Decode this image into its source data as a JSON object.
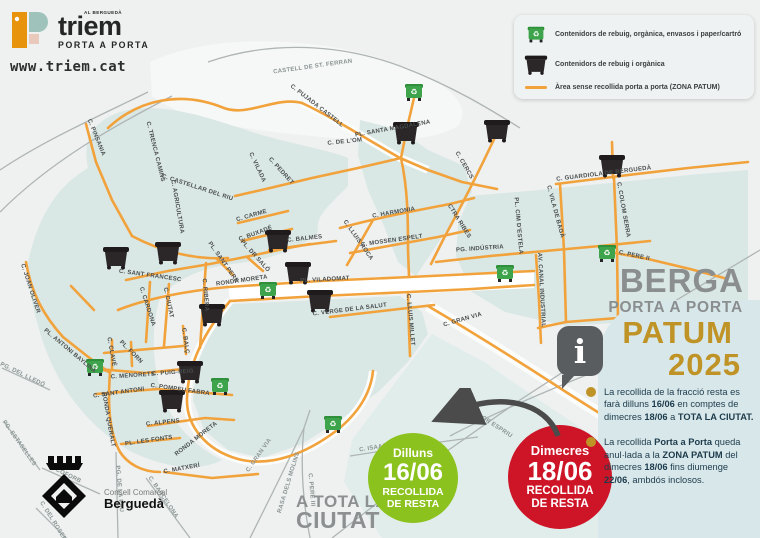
{
  "brand": {
    "tagline": "AL BERGUEDÀ",
    "name": "triem",
    "subtitle": "PORTA A PORTA",
    "website": "www.triem.cat"
  },
  "legend": {
    "items": [
      {
        "icon": "green-container-icon",
        "label": "Contenidors de rebuig, orgànica, envasos i paper/cartró"
      },
      {
        "icon": "black-container-icon",
        "label": "Contenidors de rebuig i orgànica"
      },
      {
        "icon": "orange-line-icon",
        "label": "Àrea sense recollida porta a porta (ZONA PATUM)"
      }
    ]
  },
  "info_panel": {
    "city": "BERGA",
    "subtitle": "PORTA A PORTA",
    "event": "PATUM",
    "year": "2025",
    "info_icon": "i",
    "bullets": [
      {
        "segments": [
          {
            "t": "La recollida de la fracció resta es farà dilluns "
          },
          {
            "t": "16/06",
            "b": true
          },
          {
            "t": " en comptes de dimecres "
          },
          {
            "t": "18/06",
            "b": true
          },
          {
            "t": " a "
          },
          {
            "t": "TOTA LA CIUTAT.",
            "b": true
          }
        ]
      },
      {
        "segments": [
          {
            "t": "La recollida "
          },
          {
            "t": "Porta a Porta",
            "b": true
          },
          {
            "t": " queda anul·lada a la "
          },
          {
            "t": "ZONA PATUM",
            "b": true
          },
          {
            "t": " del dimecres "
          },
          {
            "t": "18/06",
            "b": true
          },
          {
            "t": " fins diumenge "
          },
          {
            "t": "22/06",
            "b": true
          },
          {
            "t": ", ambdós inclosos."
          }
        ]
      }
    ]
  },
  "badges": {
    "green": {
      "day": "Dilluns",
      "date": "16/06",
      "line1": "RECOLLIDA",
      "line2": "DE RESTA"
    },
    "red": {
      "day": "Dimecres",
      "date": "18/06",
      "line1": "RECOLLIDA",
      "line2": "DE RESTA"
    },
    "scope_line1": "A TOTA LA",
    "scope_line2": "CIUTAT"
  },
  "footer_logo": {
    "org_line1": "Consell Comarcal",
    "org_line2": "Berguedà"
  },
  "map": {
    "streets": [
      {
        "label": "CASTELL DE ST. FERRAN",
        "x": 313,
        "y": 68,
        "r": -8,
        "g": 1
      },
      {
        "label": "C. PUJADA CASTELL",
        "x": 316,
        "y": 107,
        "r": 38
      },
      {
        "label": "PL. SANTA MAGDALENA",
        "x": 393,
        "y": 130,
        "r": -10
      },
      {
        "label": "C. DE L'OM",
        "x": 345,
        "y": 143,
        "r": -6
      },
      {
        "label": "C. PINSANIA",
        "x": 95,
        "y": 138,
        "r": 68
      },
      {
        "label": "C. TRENCA CAMINS",
        "x": 154,
        "y": 152,
        "r": 76
      },
      {
        "label": "C. CASTELLAR DEL RIU",
        "x": 197,
        "y": 189,
        "r": 18
      },
      {
        "label": "C. AGRICULTURA",
        "x": 176,
        "y": 207,
        "r": 80
      },
      {
        "label": "C. VILADA",
        "x": 256,
        "y": 168,
        "r": 65
      },
      {
        "label": "C. PEDRET",
        "x": 280,
        "y": 172,
        "r": 48
      },
      {
        "label": "C. HARMONIA",
        "x": 394,
        "y": 214,
        "r": -10
      },
      {
        "label": "C. MOSSEN ESPELT",
        "x": 392,
        "y": 242,
        "r": -8
      },
      {
        "label": "C. LLUIS ROCA",
        "x": 357,
        "y": 241,
        "r": 55
      },
      {
        "label": "C. CERCS",
        "x": 463,
        "y": 166,
        "r": 60
      },
      {
        "label": "CTRA RIBES",
        "x": 458,
        "y": 222,
        "r": 58
      },
      {
        "label": "PG. INDÚSTRIA",
        "x": 480,
        "y": 250,
        "r": -4
      },
      {
        "label": "PL. CIM D'ESTELA",
        "x": 517,
        "y": 226,
        "r": 85
      },
      {
        "label": "AV. CANAL INDUSTRIAL",
        "x": 540,
        "y": 290,
        "r": 87
      },
      {
        "label": "C. GUARDIOLA DE BERGUEDÀ",
        "x": 604,
        "y": 175,
        "r": -7
      },
      {
        "label": "C. VILA DE BAGÀ",
        "x": 554,
        "y": 212,
        "r": 75
      },
      {
        "label": "C. COLOM SERRA",
        "x": 622,
        "y": 210,
        "r": 80
      },
      {
        "label": "C. PERE II",
        "x": 634,
        "y": 257,
        "r": 12
      },
      {
        "label": "C. SANT FRANCESC",
        "x": 150,
        "y": 277,
        "r": 8
      },
      {
        "label": "C. CARDONA",
        "x": 146,
        "y": 307,
        "r": 72
      },
      {
        "label": "C. CIUTAT",
        "x": 167,
        "y": 303,
        "r": 78
      },
      {
        "label": "C. RIBERA",
        "x": 204,
        "y": 295,
        "r": 85
      },
      {
        "label": "C. BALÇ",
        "x": 184,
        "y": 341,
        "r": 82
      },
      {
        "label": "C. CLAVÉ",
        "x": 110,
        "y": 352,
        "r": 80
      },
      {
        "label": "PL. FORN",
        "x": 130,
        "y": 353,
        "r": 45
      },
      {
        "label": "C. MENORETS",
        "x": 133,
        "y": 377,
        "r": -4
      },
      {
        "label": "C. PUIG-REIG",
        "x": 173,
        "y": 374,
        "r": -4
      },
      {
        "label": "C. POMPEU FABRA",
        "x": 180,
        "y": 391,
        "r": 8
      },
      {
        "label": "C. SANT ANTONI",
        "x": 119,
        "y": 394,
        "r": -8
      },
      {
        "label": "C. ALPENS",
        "x": 163,
        "y": 424,
        "r": -6
      },
      {
        "label": "PL. LES FONTS",
        "x": 149,
        "y": 442,
        "r": -8
      },
      {
        "label": "RONDA QUERALT",
        "x": 107,
        "y": 420,
        "r": 80
      },
      {
        "label": "RONDA MORETA",
        "x": 242,
        "y": 282,
        "r": -8
      },
      {
        "label": "RONDA MORETA",
        "x": 197,
        "y": 440,
        "r": -38
      },
      {
        "label": "C. MATXERÍ",
        "x": 182,
        "y": 470,
        "r": -10
      },
      {
        "label": "C. JOAN OLIVER",
        "x": 29,
        "y": 289,
        "r": 72
      },
      {
        "label": "PL. ANTONI BAYLINA",
        "x": 69,
        "y": 352,
        "r": 40
      },
      {
        "label": "PG. DEL LLEDÓ",
        "x": 22,
        "y": 376,
        "r": 26,
        "g": 1
      },
      {
        "label": "PG. ESTASELLES",
        "x": 18,
        "y": 444,
        "r": 55,
        "g": 1
      },
      {
        "label": "C. COFORB",
        "x": 64,
        "y": 475,
        "r": 26,
        "g": 1
      },
      {
        "label": "C. DEL ROSER",
        "x": 52,
        "y": 522,
        "r": 58,
        "g": 1
      },
      {
        "label": "PG. DE LA PAU",
        "x": 118,
        "y": 489,
        "r": 85,
        "g": 1
      },
      {
        "label": "C. BARCELONA",
        "x": 162,
        "y": 498,
        "r": 56,
        "g": 1
      },
      {
        "label": "C. CARME",
        "x": 252,
        "y": 217,
        "r": -16
      },
      {
        "label": "C. BUXADÉ",
        "x": 256,
        "y": 235,
        "r": -20
      },
      {
        "label": "PL. DR SALÓ",
        "x": 254,
        "y": 257,
        "r": 48
      },
      {
        "label": "PL. SANT PERE",
        "x": 222,
        "y": 263,
        "r": 55
      },
      {
        "label": "C. BALMES",
        "x": 305,
        "y": 240,
        "r": -6
      },
      {
        "label": "PL. VILADOMAT",
        "x": 325,
        "y": 281,
        "r": -3
      },
      {
        "label": "C. VERGE DE LA SALUT",
        "x": 350,
        "y": 311,
        "r": -7
      },
      {
        "label": "C. LLUIS MILLET",
        "x": 409,
        "y": 320,
        "r": 85
      },
      {
        "label": "C. GRAN VIA",
        "x": 463,
        "y": 321,
        "r": -16
      },
      {
        "label": "C. GRAN VIA",
        "x": 260,
        "y": 456,
        "r": -55,
        "g": 1
      },
      {
        "label": "RASA DELS MOLINS",
        "x": 290,
        "y": 483,
        "r": -73,
        "g": 1
      },
      {
        "label": "C. PERE III",
        "x": 310,
        "y": 490,
        "r": 85,
        "g": 1
      },
      {
        "label": "C. ISAAC ALBÉNIZ",
        "x": 388,
        "y": 447,
        "r": -9,
        "g": 1
      },
      {
        "label": "C. SALVADOR ESPRIU",
        "x": 482,
        "y": 419,
        "r": 33,
        "g": 1
      }
    ],
    "green_containers": [
      [
        414,
        92
      ],
      [
        95,
        367
      ],
      [
        268,
        290
      ],
      [
        220,
        386
      ],
      [
        333,
        424
      ],
      [
        505,
        273
      ],
      [
        607,
        253
      ]
    ],
    "black_containers": [
      [
        116,
        257
      ],
      [
        168,
        252
      ],
      [
        406,
        132
      ],
      [
        497,
        130
      ],
      [
        612,
        165
      ],
      [
        278,
        240
      ],
      [
        298,
        272
      ],
      [
        320,
        300
      ],
      [
        212,
        314
      ],
      [
        190,
        371
      ],
      [
        172,
        400
      ]
    ]
  },
  "colors": {
    "street_orange": "#F2A23B",
    "zone_teal": "#D9E7E5",
    "title_gray": "#8B8E8F",
    "gold": "#BF9326",
    "badge_green": "#8CC21D",
    "badge_red": "#CE1527",
    "container_green": "#3EA44B",
    "container_black": "#2B2627"
  }
}
